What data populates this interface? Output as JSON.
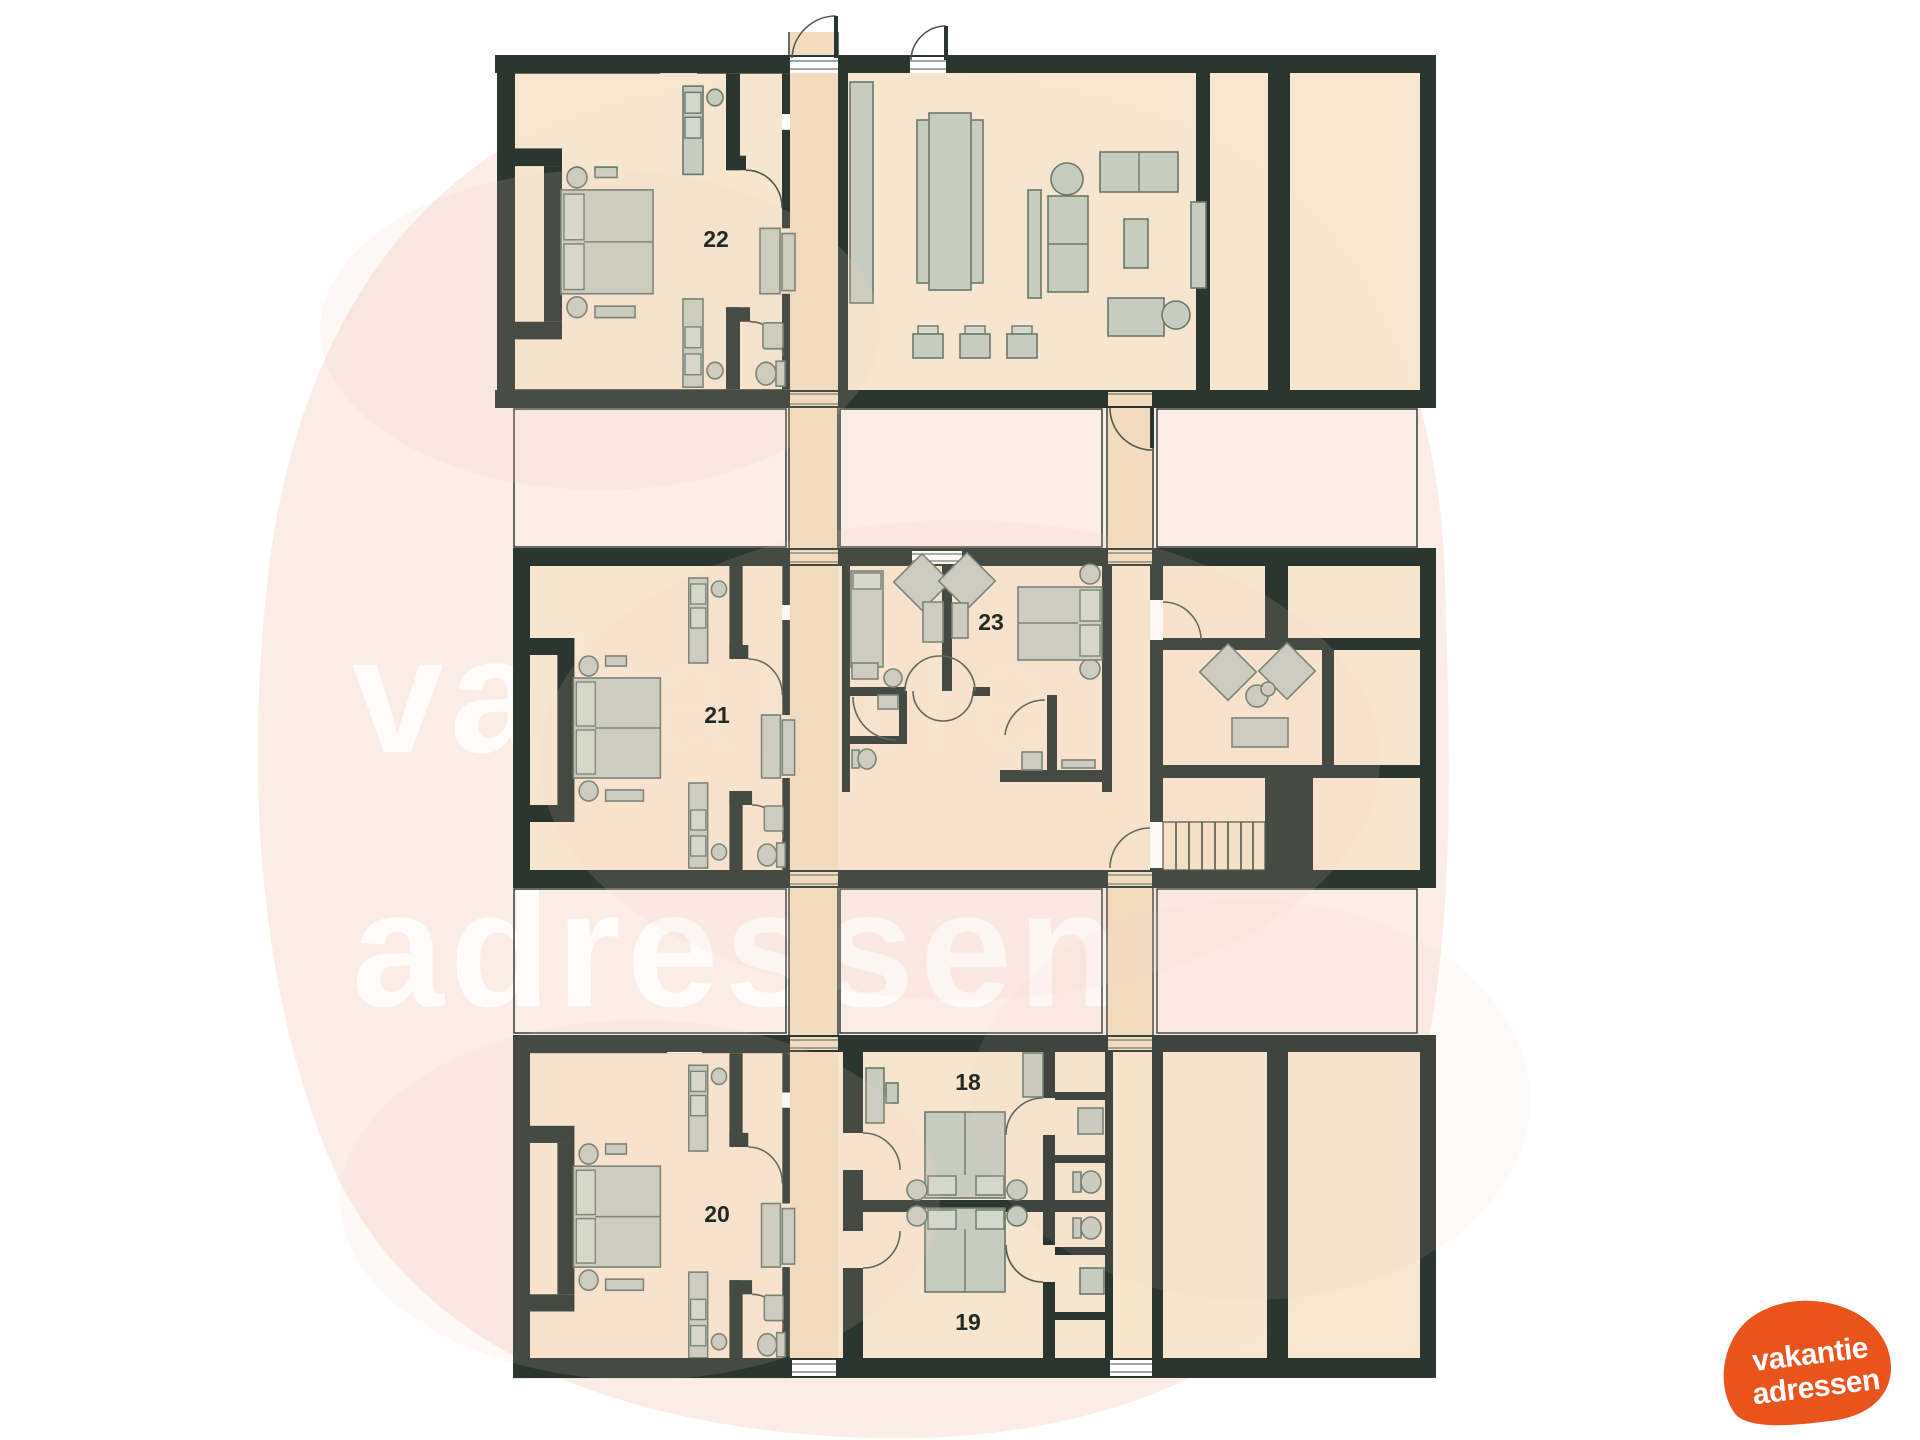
{
  "watermark": {
    "line1": "vakantie",
    "line2": "adressen",
    "color": "#FFFFFF"
  },
  "logo": {
    "line1": "vakantie",
    "line2": "adressen",
    "background": "#E9541D",
    "text_color": "#FFFFFF"
  },
  "floor_plan": {
    "rooms": [
      {
        "id": "room-22",
        "label": "22"
      },
      {
        "id": "room-21",
        "label": "21"
      },
      {
        "id": "room-20",
        "label": "20"
      },
      {
        "id": "room-23",
        "label": "23"
      },
      {
        "id": "room-18",
        "label": "18"
      },
      {
        "id": "room-19",
        "label": "19"
      }
    ],
    "colors": {
      "wall": "#2B3630",
      "floor": "#F8E5CC",
      "corridor": "#F2DCBD",
      "courtyard_outline": "#333E37",
      "furniture": "#C7CCBE",
      "furniture_stroke": "#6A796D",
      "label": "#232A24",
      "background_blob": "#FBECE5"
    }
  }
}
